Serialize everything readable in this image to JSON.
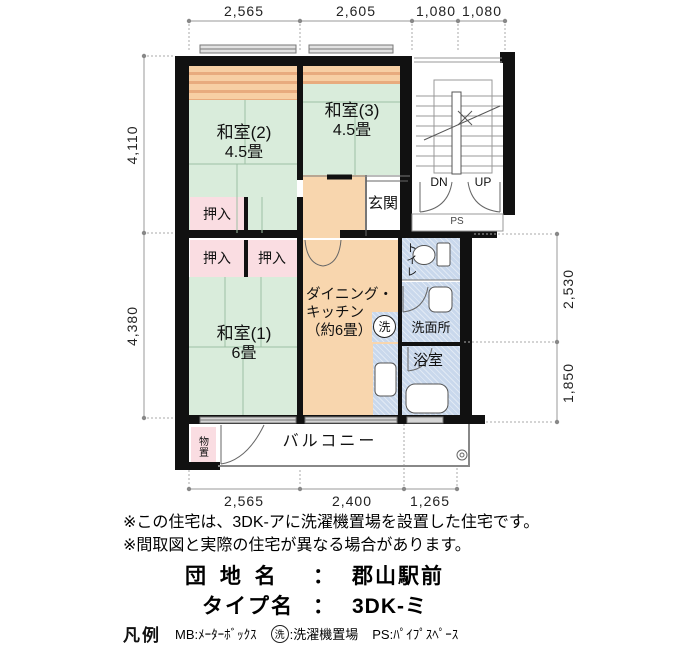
{
  "plan": {
    "rooms": {
      "washitsu2": {
        "name": "和室(2)",
        "size": "4.5畳"
      },
      "washitsu3": {
        "name": "和室(3)",
        "size": "4.5畳"
      },
      "washitsu1": {
        "name": "和室(1)",
        "size": "6畳"
      },
      "dk": {
        "line1": "ダイニング・",
        "line2": "キッチン",
        "line3": "（約6畳）"
      },
      "genkan": "玄関",
      "oshiire": "押入",
      "toilet": "トイレ",
      "washroom": "洗面所",
      "bath": "浴室",
      "balcony": "バルコニー",
      "storage": "物置",
      "laundry_symbol": "洗",
      "stairs_down": "DN",
      "stairs_up": "UP",
      "pipe_space": "PS"
    },
    "dimensions": {
      "top": [
        "2,565",
        "2,605",
        "1,080",
        "1,080"
      ],
      "left": [
        "4,110",
        "4,380"
      ],
      "right": [
        "2,530",
        "1,850"
      ],
      "bottom": [
        "2,565",
        "2,400",
        "1,265"
      ]
    }
  },
  "notes": [
    "※この住宅は、3DK-アに洗濯機置場を設置した住宅です。",
    "※間取図と実際の住宅が異なる場合があります。"
  ],
  "info": {
    "estate_label": "団 地 名",
    "estate_sep": "：",
    "estate_name": "郡山駅前",
    "type_label": "タイプ名",
    "type_sep": "：",
    "type_name": "3DK-ミ"
  },
  "legend": {
    "label": "凡例",
    "mb": "MB:ﾒｰﾀｰﾎﾞｯｸｽ",
    "laundry_symbol": "洗",
    "laundry_desc": ":洗濯機置場",
    "ps": "PS:ﾊﾟｲﾌﾟｽﾍﾟｰｽ"
  },
  "colors": {
    "tatami_green": "#d9ecdb",
    "dk_orange": "#f8d6ae",
    "closet_pink": "#fadde2",
    "water_blue": "#c9d8ec",
    "stripe_orange": "#e8ab7e",
    "wall_black": "#111111",
    "dim_gray": "#999999"
  }
}
